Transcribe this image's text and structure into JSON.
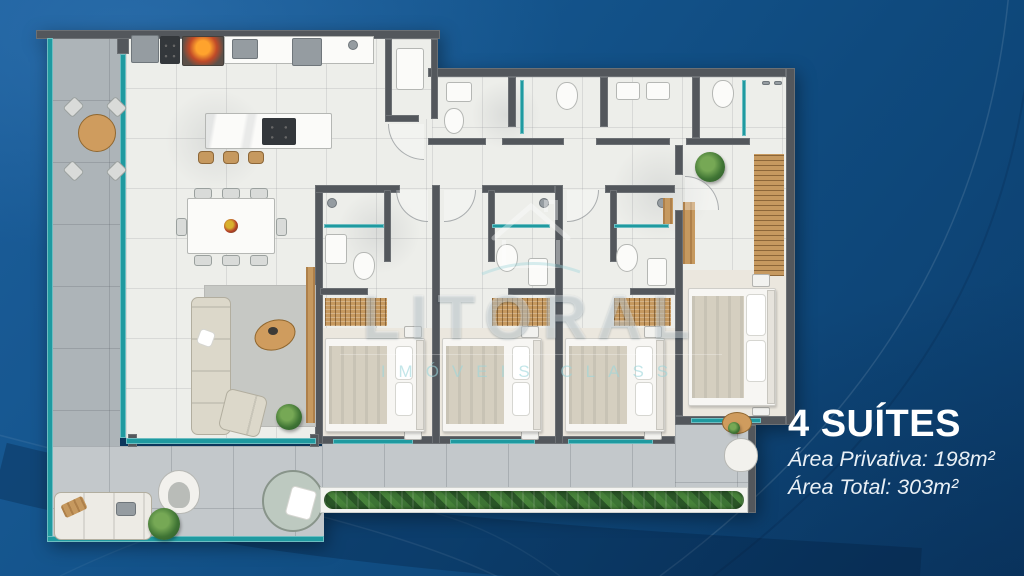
{
  "info_panel": {
    "title": "4 SUÍTES",
    "area_privativa": "Área Privativa: 198m²",
    "area_total": "Área Total: 303m²"
  },
  "watermark": {
    "brand": "LITORAL",
    "tagline": "IMÓVEIS CLASS"
  },
  "colors": {
    "background": "#0f4a7e",
    "wall": "#53575c",
    "glass_teal": "#1f9aa0",
    "wood": "#c6995f",
    "floor": "#edeeea",
    "terrace": "#c3c8cb",
    "hedge_green": "#315f2c",
    "text": "#ffffff",
    "watermark_teal": "#9bd5db"
  }
}
